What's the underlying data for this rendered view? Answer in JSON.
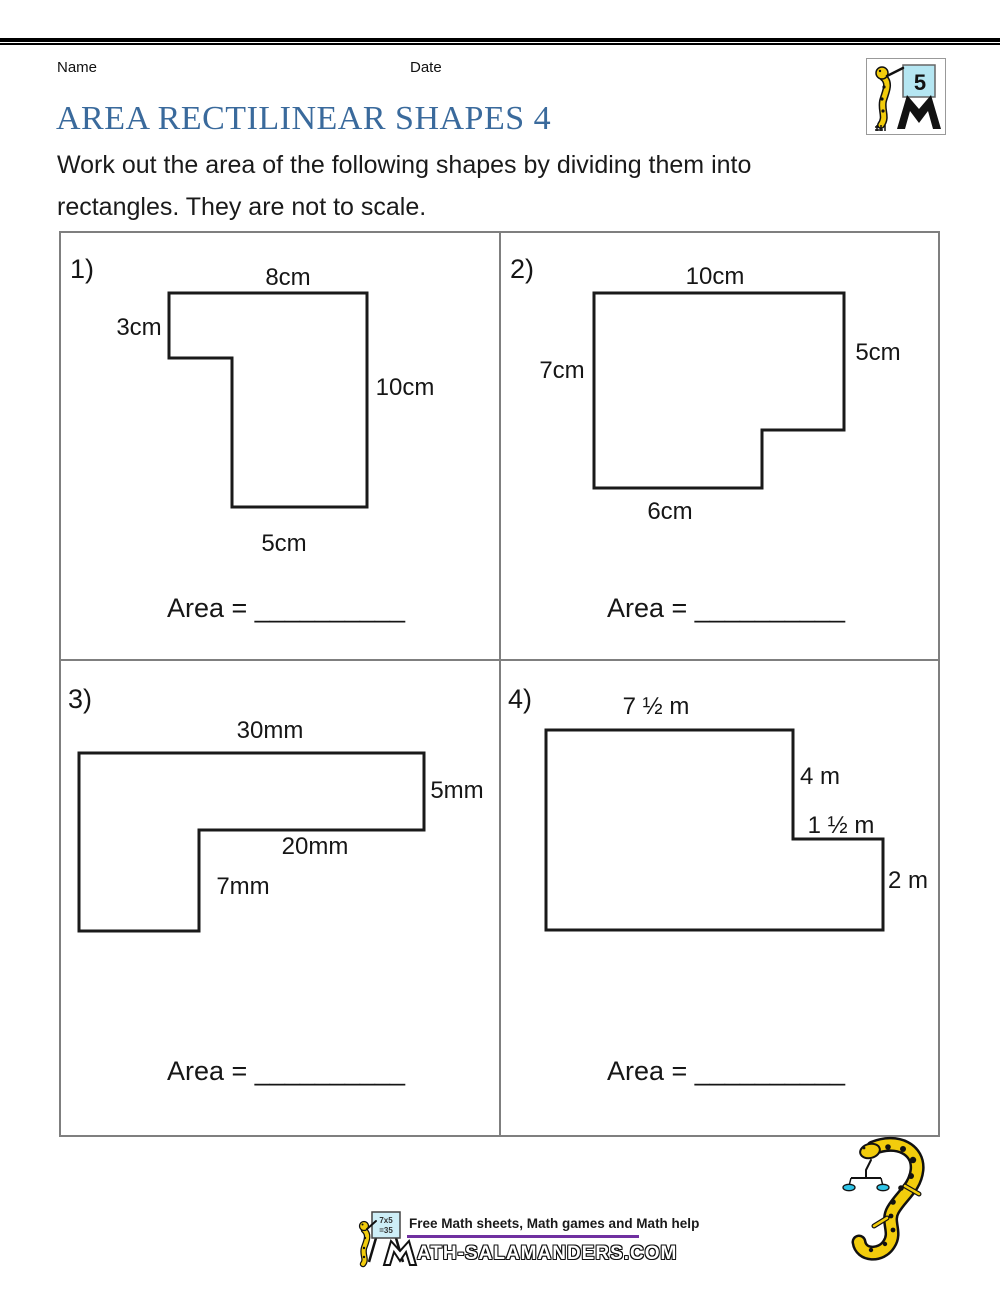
{
  "header": {
    "name_label": "Name",
    "date_label": "Date",
    "title": "AREA RECTILINEAR SHAPES 4",
    "instructions_line1": "Work out the area of the following shapes by dividing them into",
    "instructions_line2": "rectangles. They are not to scale."
  },
  "logo": {
    "grade": "5"
  },
  "problems": [
    {
      "number": "1)",
      "labels": {
        "top": "8cm",
        "left": "3cm",
        "right": "10cm",
        "bottom": "5cm"
      },
      "area_label": "Area = __________"
    },
    {
      "number": "2)",
      "labels": {
        "top": "10cm",
        "left": "7cm",
        "right": "5cm",
        "bottom": "6cm"
      },
      "area_label": "Area = __________"
    },
    {
      "number": "3)",
      "labels": {
        "top": "30mm",
        "right": "5mm",
        "step": "20mm",
        "inner": "7mm"
      },
      "area_label": "Area = __________"
    },
    {
      "number": "4)",
      "labels": {
        "top": "7 ½ m",
        "upper_right": "4 m",
        "step": "1 ½ m",
        "lower_right": "2 m"
      },
      "area_label": "Area = __________"
    }
  ],
  "footer": {
    "tagline": "Free Math sheets, Math games and Math help",
    "wordmark_m": "M",
    "wordmark_rest": "ATH-SALAMANDERS.COM",
    "board_line1": "7x5",
    "board_line2": "=35"
  },
  "colors": {
    "title_blue": "#3a6a9c",
    "accent_purple": "#7030a0",
    "salamander_yellow": "#f2cc0c",
    "board_blue": "#b5e6f2",
    "pan_cyan": "#2fc5e8",
    "table_border": "#7f7f7f",
    "shape_stroke": "#1a1a1a"
  }
}
